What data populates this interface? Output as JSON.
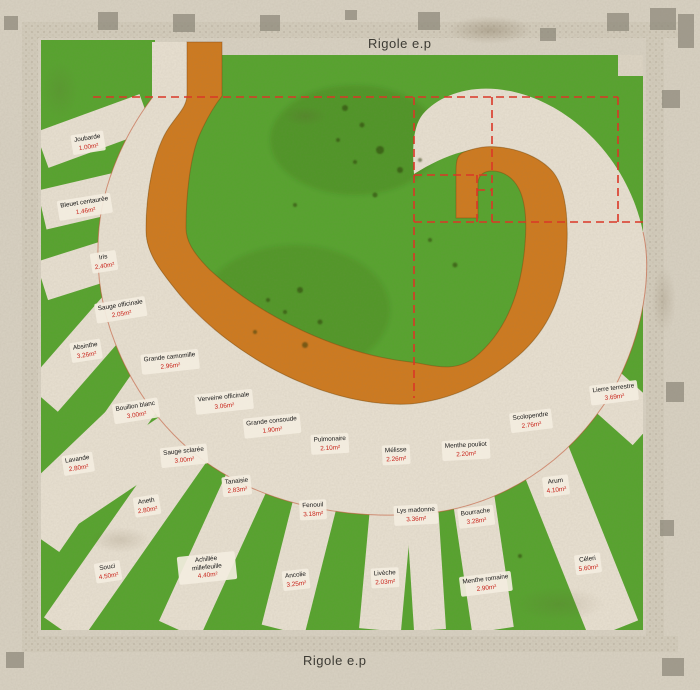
{
  "title_top": "Rigole e.p",
  "title_bottom": "Rigole e.p",
  "colors": {
    "paper": "#d9d2c3",
    "grass_green": "#56a42d",
    "path_beige": "#e9e1d2",
    "spiral_orange": "#cf7a1e",
    "construction_red": "#e03222",
    "label_area_red": "#c8231a",
    "tile_gray": "#8f897c"
  },
  "beds": [
    {
      "name": "Joubarde",
      "area": "1.00m²",
      "x": 88,
      "y": 143
    },
    {
      "name": "Bleuet centaurée",
      "area": "1.46m²",
      "x": 85,
      "y": 207
    },
    {
      "name": "Iris",
      "area": "2.40m²",
      "x": 104,
      "y": 262
    },
    {
      "name": "Sauge officinale",
      "area": "2.05m²",
      "x": 121,
      "y": 310
    },
    {
      "name": "Absinthe",
      "area": "3.26m²",
      "x": 86,
      "y": 351
    },
    {
      "name": "Grande camomille",
      "area": "2.96m²",
      "x": 170,
      "y": 362
    },
    {
      "name": "Bouillon blanc",
      "area": "3.00m²",
      "x": 136,
      "y": 411
    },
    {
      "name": "Verveine officinale",
      "area": "3.06m²",
      "x": 224,
      "y": 402
    },
    {
      "name": "Grande consoude",
      "area": "1.90m²",
      "x": 272,
      "y": 426
    },
    {
      "name": "Lavande",
      "area": "2.80m²",
      "x": 78,
      "y": 464
    },
    {
      "name": "Sauge sclarée",
      "area": "3.00m²",
      "x": 184,
      "y": 456
    },
    {
      "name": "Pulmonaire",
      "area": "2.10m²",
      "x": 330,
      "y": 444
    },
    {
      "name": "Tanaisie",
      "area": "2.83m²",
      "x": 237,
      "y": 486
    },
    {
      "name": "Aneth",
      "area": "2.80m²",
      "x": 147,
      "y": 506
    },
    {
      "name": "Mélisse",
      "area": "2.26m²",
      "x": 396,
      "y": 455
    },
    {
      "name": "Fenouil",
      "area": "3.18m²",
      "x": 313,
      "y": 510
    },
    {
      "name": "Menthe pouliot",
      "area": "2.20m²",
      "x": 466,
      "y": 450
    },
    {
      "name": "Lys madonne",
      "area": "3.36m²",
      "x": 416,
      "y": 515
    },
    {
      "name": "Souci",
      "area": "4.50m²",
      "x": 108,
      "y": 572
    },
    {
      "name": "Achillée millefeuille",
      "area": "4.40m²",
      "x": 207,
      "y": 568
    },
    {
      "name": "Ancolie",
      "area": "3.25m²",
      "x": 296,
      "y": 580
    },
    {
      "name": "Bourrache",
      "area": "3.28m²",
      "x": 476,
      "y": 517
    },
    {
      "name": "Livèche",
      "area": "2.03m²",
      "x": 385,
      "y": 578
    },
    {
      "name": "Menthe romaine",
      "area": "2.90m²",
      "x": 486,
      "y": 584
    },
    {
      "name": "Scolopendre",
      "area": "2.76m²",
      "x": 531,
      "y": 421
    },
    {
      "name": "Arum",
      "area": "4.10m²",
      "x": 556,
      "y": 486
    },
    {
      "name": "Lierre terrestre",
      "area": "3.69m²",
      "x": 614,
      "y": 393
    },
    {
      "name": "Céleri",
      "area": "5.60m²",
      "x": 588,
      "y": 564
    }
  ]
}
